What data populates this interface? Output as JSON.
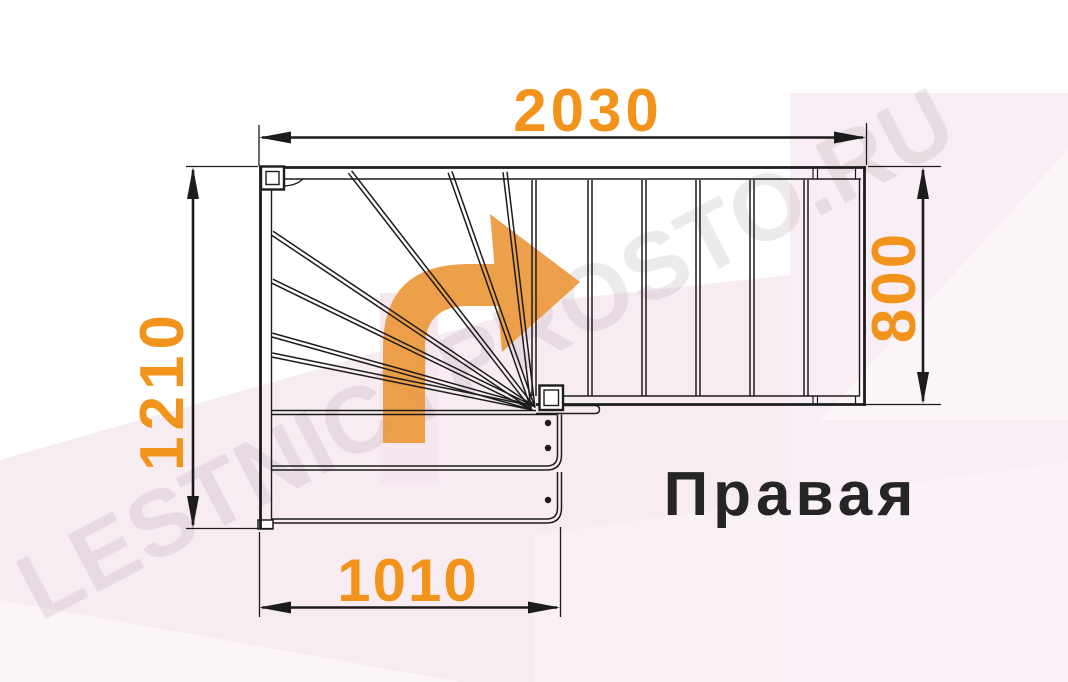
{
  "label": {
    "stair_type": "Правая"
  },
  "watermark": {
    "text": "LESTNICYPROSTO.RU"
  },
  "dimensions": {
    "top": "2030",
    "left": "1210",
    "right": "800",
    "bottom": "1010"
  },
  "colors": {
    "dimension_orange": "#F2941C",
    "arrow_orange": "#EC993D",
    "line_black": "#1C1C1C",
    "background_pink": "#F8ECF3"
  },
  "icons": {
    "turn_arrow": "curved-right-turn-arrow"
  }
}
